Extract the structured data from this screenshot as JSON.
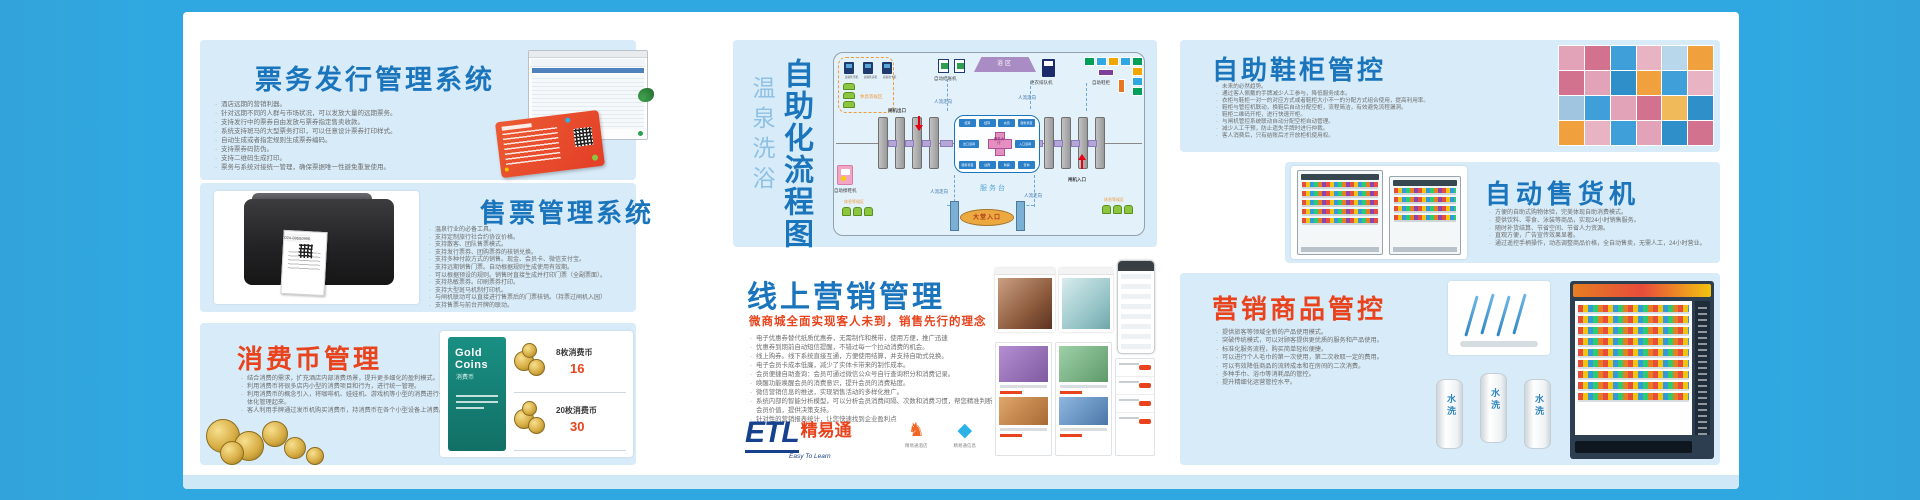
{
  "colors": {
    "frame": "#2fa8e1",
    "panel": "#d7ebf8",
    "accent_blue": "#1b75bc",
    "accent_red": "#e8431c"
  },
  "panels": {
    "ticketing": {
      "title": "票务发行管理系统",
      "bullets": [
        "酒店远期的营销利器。",
        "针对远期不同的人群与市场状况，可以发放大量的远期票务。",
        "支持发行中的票券自由发放与票券指定售卖收款。",
        "系统支持斑马的大型票务打印，可以任意设计票券打印样式。",
        "自动生成或者指定规则生成票券编码。",
        "支持票券码防伪。",
        "支持二维码生成打印。",
        "票务与系统对接统一管理，确保票据唯一性避免重复使用。"
      ]
    },
    "ticket_sales": {
      "title": "售票管理系统",
      "printer_phone": "024-88600996",
      "bullets": [
        "温泉行业的必备工具。",
        "支持定制旅行社合约协议价格。",
        "支持散客、团队售票模式。",
        "支持发行票券、团购票券的核销兑换。",
        "支持多种付款方式的销售。现金、会员卡、微信支付宝。",
        "支持远期销售门票。自动根据规则生成使用有效期。",
        "可以根据预设的规则。销售时直接生成并打印门票（全副票面）。",
        "支持热敏票券。印刷票券打印。",
        "支持大型斑马机制打印机。",
        "与闸机联动可以直接进行售票后的门票核销。（持票过闸机入园）",
        "支持售票与前台开牌的联动。"
      ]
    },
    "coins": {
      "title": "消费币管理",
      "bullets": [
        "结合消费的需求，扩充酒店内部消费场景，提升更多细化的盈利模式。",
        "利用消费币将很多店内小型的消费项目和行为，进行统一管理。",
        "利用消费币的概念引入，将咖啡机、娃娃机、游戏机等小型的消费进行一体化管理起来。",
        "客人利用手牌通过发币机购买消费币，持消费币在各个小型设备上消费。"
      ],
      "card_brand": "Gold Coins",
      "card_label": "消费币",
      "offers": [
        {
          "label": "8枚消费币",
          "price": "16"
        },
        {
          "label": "20枚消费币",
          "price": "30"
        }
      ]
    },
    "flow": {
      "side_title": "温泉洗浴",
      "main_title": "自助化流程图",
      "waiting_area": "休息等候区",
      "machines": [
        "自助售币机",
        "自助售货机",
        "自助领卡机"
      ],
      "checkout_machine": "自动结账机",
      "bath_zone": "浴区",
      "queue_machine": "更衣排队机",
      "shoe_lockers": "自助鞋柜",
      "gate_exit": "闸机出口",
      "gate_entry": "闸机入口",
      "people_flow": "人流走向",
      "service_desk": "服务台",
      "lobby_entrance": "大堂入口",
      "shoe_shine": "自助擦鞋机",
      "service_hall": "服务大厅",
      "service_top": [
        "结算",
        "结算",
        "充值",
        "服务项目"
      ],
      "service_mid": [
        "出口道闸",
        "入口道闸"
      ],
      "service_bottom": [
        "服务项目",
        "迎宾",
        "购票",
        "查询"
      ]
    },
    "marketing": {
      "title": "线上营销管理",
      "subtitle": "微商城全面实现客人未到，销售先行的理念",
      "bullets": [
        "电子优惠券替代纸质优惠券，无需制作和携带，使用方便，推广迅速",
        "优惠券到期前自动短信提醒，不错过每一个拉动消费的机会。",
        "线上购券。线下系统直接互通，方便使用结算，并支持自助式兑换。",
        "电子会员卡成本低廉，减少了实体卡带来的制作成本。",
        "会员便捷自助查询：会员可通过微信公众号自行查询积分和消费记录。",
        "唤醒功能唤醒会员的消费意识，提升会员的消费粘度。",
        "微信营销信息的推送，实现销售活动的多样化推广。",
        "系统内部的智能分析模型，可以分析会员消费间隔、次数和消费习惯，帮您精准判断会员价值，提供决策支持。",
        "针对性的营销报表统计，让您快速找到企业盈利点"
      ],
      "logo_etl": "ETL",
      "logo_cn": "精易通",
      "logo_en": "Easy To Learn",
      "logo_items": [
        {
          "label": "精易通酒店",
          "glyph": "♞",
          "color": "#f26522"
        },
        {
          "label": "精易通信息",
          "glyph": "◆",
          "color": "#2bb3e8"
        },
        {
          "label": "精易通智控",
          "glyph": "⚙",
          "color": "#1e3f8f"
        }
      ]
    },
    "shoe": {
      "title": "自助鞋柜管控",
      "bullets": [
        "未来的必然趋势。",
        "通过客人佩戴的手牌减少人工参与，降低服务成本。",
        "衣柜与鞋柜一对一的对应方式或者鞋柜大小不一的分配方式组合使用，提高利用率。",
        "鞋柜与管控机联动，换鞋后自动分配空柜，流程简洁，有效避免流程漏洞。",
        "鞋柜二维码开柜，进行快速开柜。",
        "与闸机管控系统联动自动分配空柜自动管理。",
        "减少人工干预，防止遗失手牌时进行仲裁。",
        "客人消费后，只有结账后才开放柜机使用权。"
      ],
      "tiles": [
        "#e2a3b8",
        "#d2728f",
        "#3f9fd8",
        "#e8b4c4",
        "#b9d7ea",
        "#f0a03c",
        "#d2728f",
        "#e2a3b8",
        "#2f8fc9",
        "#f0a03c",
        "#3f9fd8",
        "#e8b4c4",
        "#9fc5e0",
        "#3f9fd8",
        "#e2a3b8",
        "#d2728f",
        "#f0b95a",
        "#2f8fc9",
        "#f0a03c",
        "#e8b4c4",
        "#3f9fd8",
        "#e2a3b8",
        "#2f8fc9",
        "#d2728f"
      ]
    },
    "vending": {
      "title": "自动售货机",
      "bullets": [
        "方便的自助式购物体验，完美体现自助消费模式。",
        "提供饮料、零食、泳装等商品，实现24小时销售服务。",
        "随时补货结算、节省空间、节省人力资源。",
        "直观方便，广告宣传效果显著。",
        "通过遥控手柄操作，动态调整商品价格，全自动售卖，无需人工，24小时营业。"
      ]
    },
    "merch": {
      "title": "营销商品管控",
      "towel_label": "水洗",
      "bullets": [
        "提供旅客等领域全新的产品使用模式。",
        "突破传统模式，可以对顾客提供更优质的服务和产品使用。",
        "标准化服务流程，购买简单轻松便捷。",
        "可以进行个人毛巾的第一次使用，第二次收取一定的费用。",
        "可以有效降低商品的流转成本和在房间的二次消费。",
        "多种手巾、浴巾等消耗品的管控。",
        "提升精细化运营管控水平。"
      ]
    }
  }
}
